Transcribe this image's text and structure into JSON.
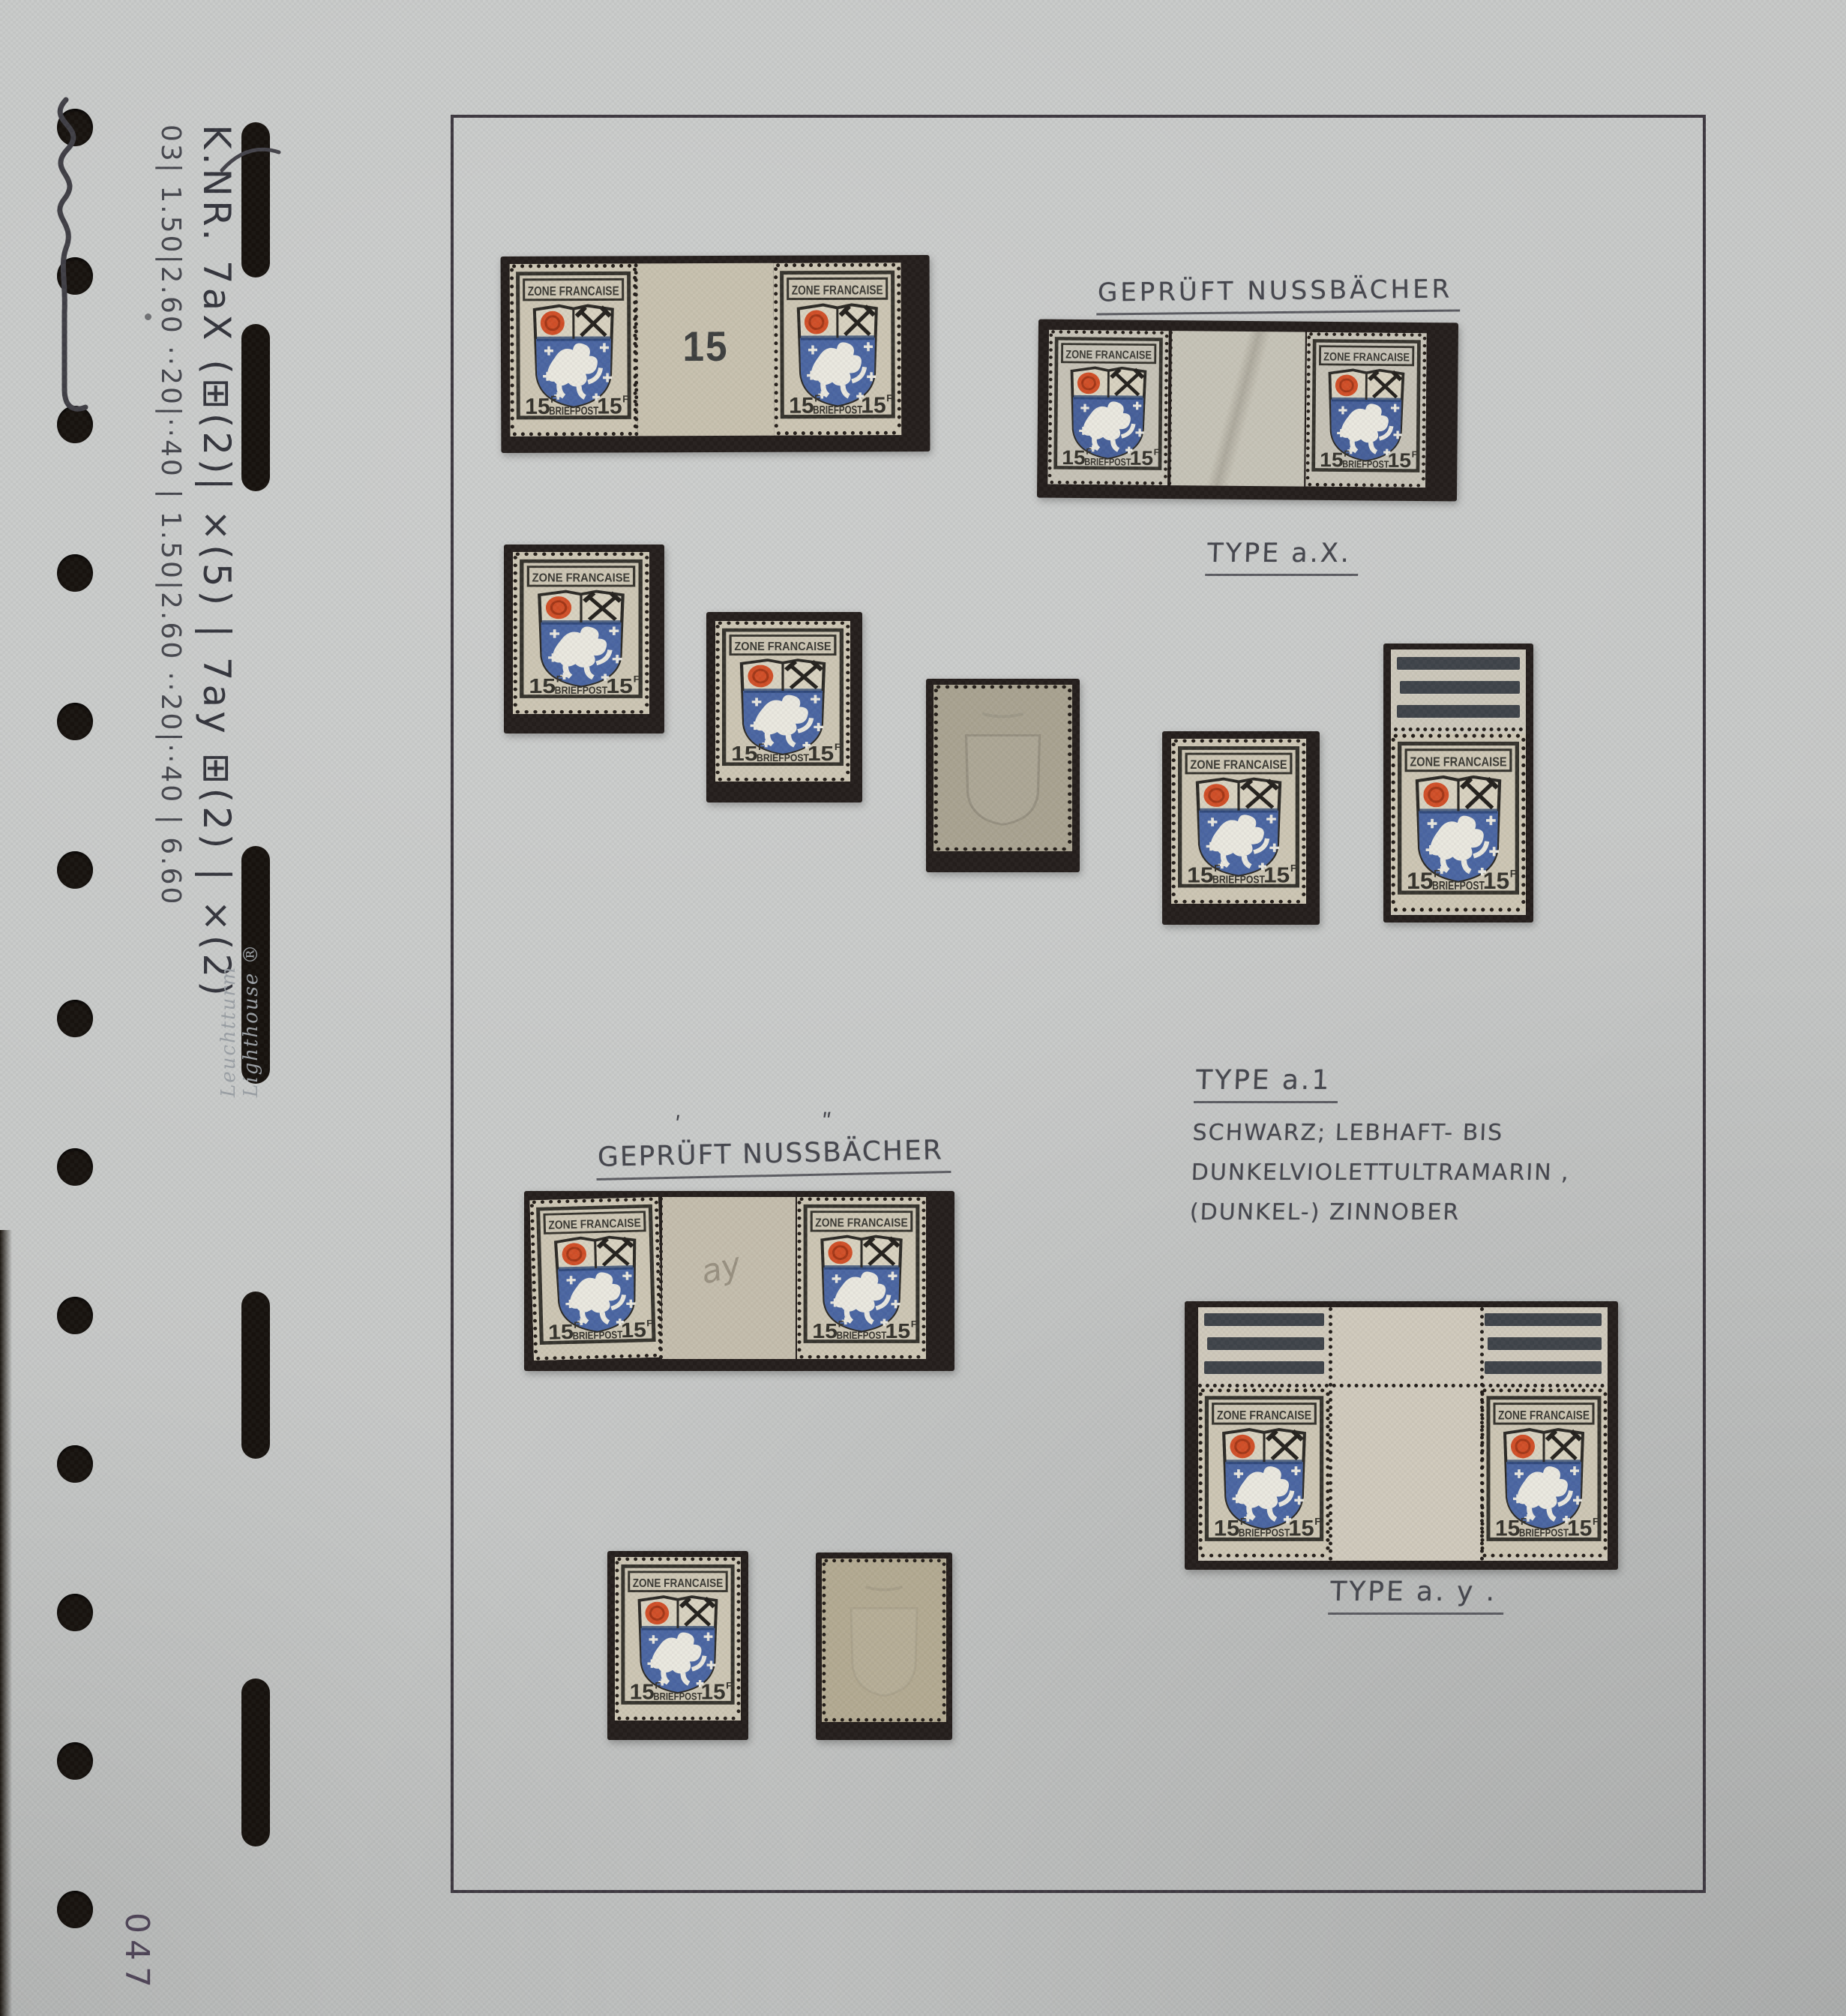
{
  "photo": {
    "page_number_vertical": "047",
    "brand_vertical": "Leuchtturm   Lighthouse ®",
    "margin_note_line1": "K.NR. 7aX (⊞(2)| ×(5) | 7ay ⊞(2) | ×(2)",
    "margin_note_line2": "03|  1.50|2.60 ··20|··40 |  1.50|2.60 ··20|··40 | 6.60"
  },
  "stamp": {
    "country": "ZONE FRANCAISE",
    "value": "15",
    "currency_letter": "F",
    "service": "BRIEFPOST",
    "gutter_number": "15",
    "gutter_pencil_note": "ay"
  },
  "annotations": {
    "gepruft_top": "GEPRÜFT NUSSBÄCHER",
    "type_ax": "TYPE a.X.",
    "type_a1_title": "TYPE a.1",
    "type_a1_line1": "SCHWARZ; LEBHAFT- BIS",
    "type_a1_line2": "DUNKELVIOLETTULTRAMARIN ,",
    "type_a1_line3": "(DUNKEL-) ZINNOBER",
    "gepruft_lower": "GEPRÜFT NUSSBÄCHER",
    "gepruft_lower_mark1": "ʹ",
    "gepruft_lower_mark2": "ʺ",
    "type_ay": "TYPE a. y ."
  },
  "colors": {
    "page": "#c7c9c8",
    "mount": "#251f1d",
    "stamp_paper": "#cdc6b4",
    "stamp_blue": "#4b66a2",
    "stamp_red": "#d14f28",
    "margin_bars": "#3f444a",
    "pencil": "#45464d",
    "ink": "#34353d"
  }
}
